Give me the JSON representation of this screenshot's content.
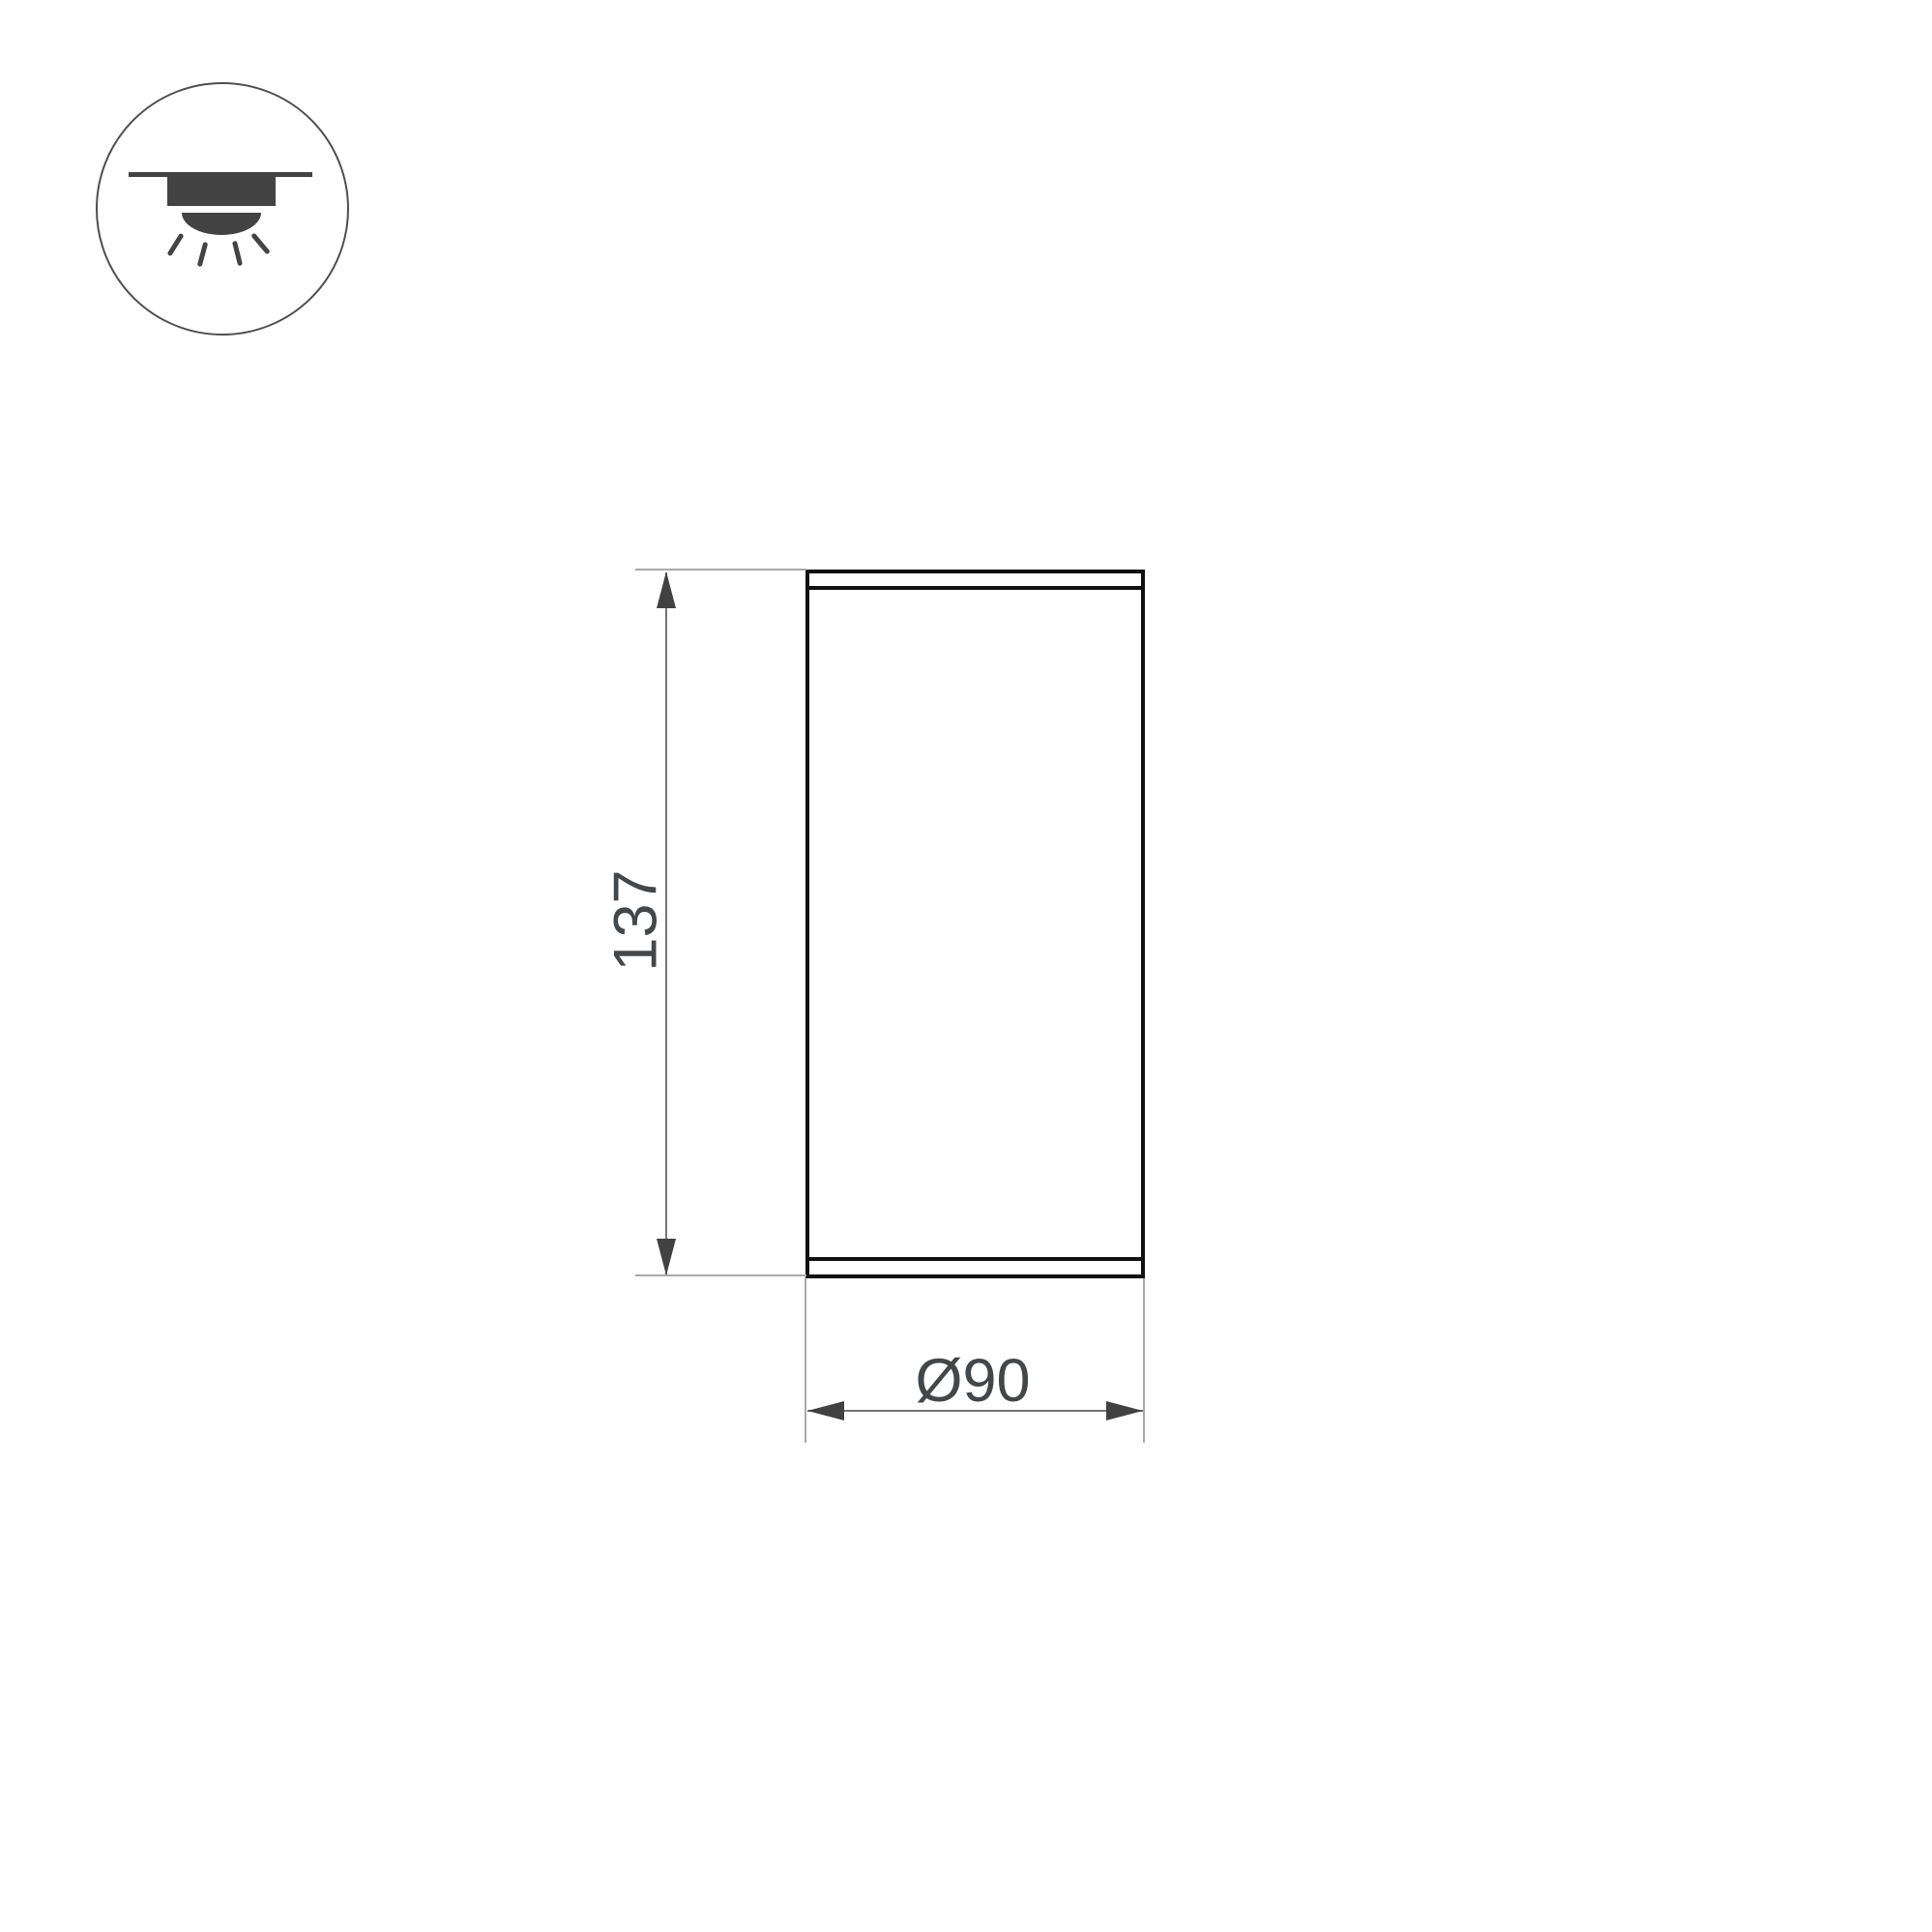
{
  "icon": {
    "label": "surface-mounted-ceiling-downlight"
  },
  "dimensions": {
    "height": {
      "value": "137"
    },
    "diameter": {
      "value": "Ø90"
    }
  },
  "colors": {
    "bg": "#ffffff",
    "outline": "#111111",
    "icon-fill": "#434343",
    "circle-stroke": "#4f4f4f",
    "dim-line": "#757575",
    "ext-line": "#a9a9a9",
    "arrow": "#414141",
    "dim-text": "#44474a"
  }
}
